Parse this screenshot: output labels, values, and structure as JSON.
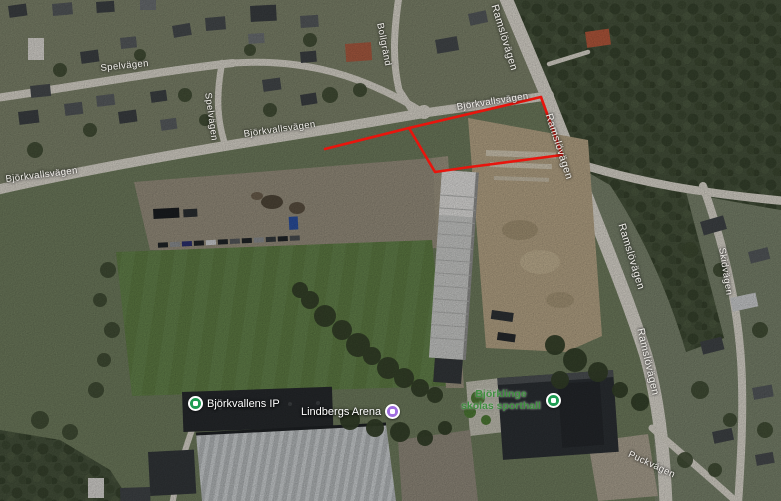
{
  "map": {
    "view_type": "satellite",
    "annotation_color": "#e8150d",
    "road_labels": [
      {
        "text": "Spelvägen"
      },
      {
        "text": "Spelvägen"
      },
      {
        "text": "Bollgränd"
      },
      {
        "text": "Björkvallsvägen"
      },
      {
        "text": "Björkvallsvägen"
      },
      {
        "text": "Björkvallsvägen"
      },
      {
        "text": "Ramslövägen"
      },
      {
        "text": "Ramslövägen"
      },
      {
        "text": "Ramslövägen"
      },
      {
        "text": "Ramslövägen"
      },
      {
        "text": "Skidvägen"
      },
      {
        "text": "Puckvägen"
      }
    ],
    "pois": [
      {
        "name": "Björkvallens IP",
        "pin_color": "#1e9c52",
        "label_color": "#ffffff"
      },
      {
        "name": "Lindbergs Arena",
        "pin_color": "#a06ee0",
        "label_color": "#ffffff"
      },
      {
        "name": "Björklinge skolas sporthall",
        "pin_color": "#1e9c52",
        "label_color": "#3f8f3f"
      }
    ]
  }
}
